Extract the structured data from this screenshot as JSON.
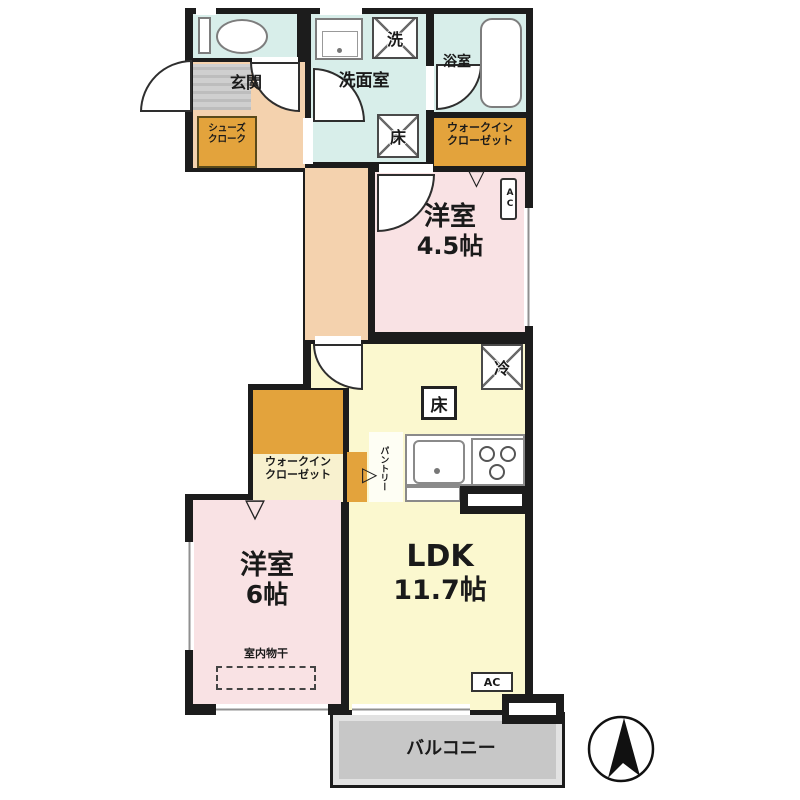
{
  "labels": {
    "genkan": "玄関",
    "shoes_cloak_1": "シューズ",
    "shoes_cloak_2": "クローク",
    "washroom": "洗面室",
    "bathroom": "浴室",
    "wic_top_1": "ウォークイン",
    "wic_top_2": "クローゼット",
    "wic_bottom_1": "ウォークイン",
    "wic_bottom_2": "クローゼット",
    "room45_1": "洋室",
    "room45_2": "4.5帖",
    "room6_1": "洋室",
    "room6_2": "6帖",
    "ldk_1": "LDK",
    "ldk_2": "11.7帖",
    "pantry": "パントリー",
    "indoor_drying": "室内物干",
    "balcony": "バルコニー",
    "ac_top": "AC",
    "ac_bottom": "AC"
  },
  "symbols": {
    "washer": "洗",
    "floor_hatch": "床",
    "fridge": "冷",
    "floor_storage": "床",
    "window_marker": "▽",
    "door_marker": "▷"
  },
  "colors": {
    "wall": "#1c1c1c",
    "wet": "#d8eeea",
    "hall": "#f4d2ae",
    "closet": "#e3a33c",
    "bedroom": "#f9e2e4",
    "ldk": "#fbf8cf",
    "balcony": "#c7c7c7",
    "tile": "#c2c2c2"
  }
}
